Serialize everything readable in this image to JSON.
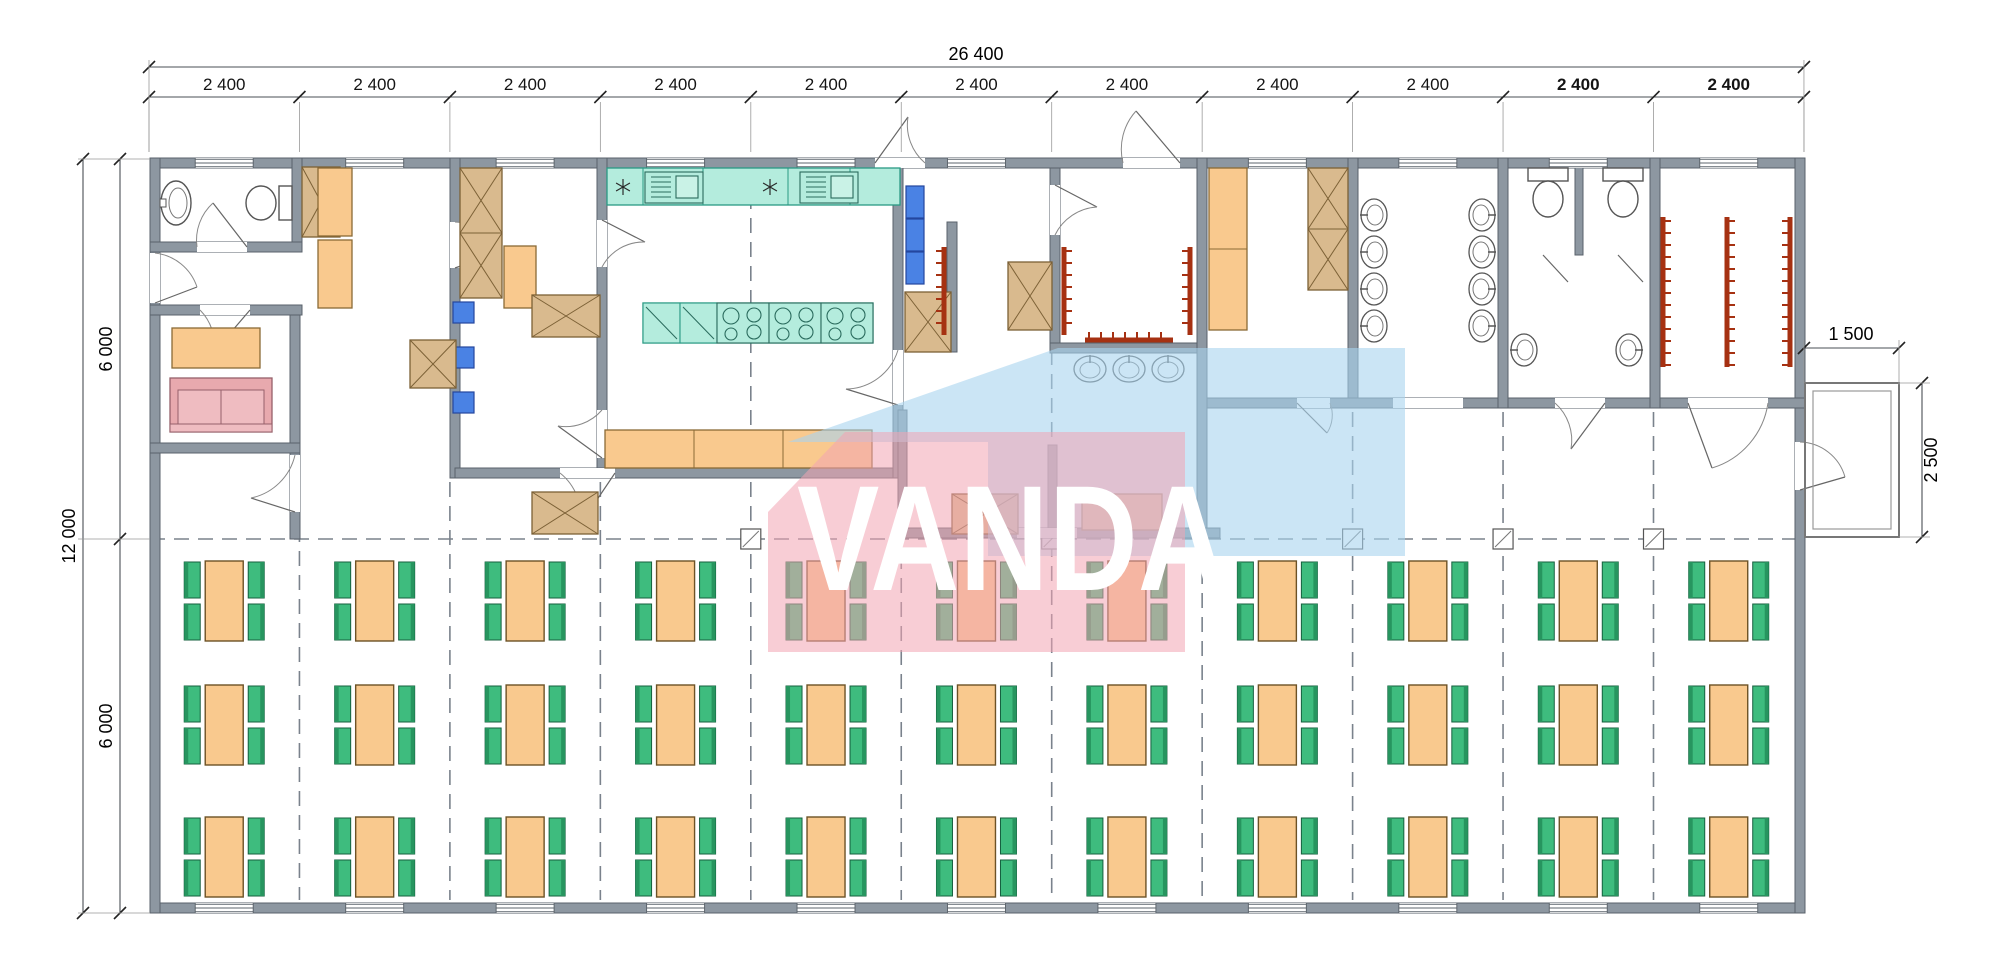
{
  "watermark": {
    "text": "VANDA"
  },
  "dimensions": {
    "top_total": {
      "label": "26 400"
    },
    "bays": [
      {
        "label": "2 400",
        "bold": false
      },
      {
        "label": "2 400",
        "bold": false
      },
      {
        "label": "2 400",
        "bold": false
      },
      {
        "label": "2 400",
        "bold": false
      },
      {
        "label": "2 400",
        "bold": false
      },
      {
        "label": "2 400",
        "bold": false
      },
      {
        "label": "2 400",
        "bold": false
      },
      {
        "label": "2 400",
        "bold": false
      },
      {
        "label": "2 400",
        "bold": false
      },
      {
        "label": "2 400",
        "bold": true
      },
      {
        "label": "2 400",
        "bold": true
      }
    ],
    "left_total": {
      "label": "12 000"
    },
    "left_halves": [
      {
        "label": "6 000"
      },
      {
        "label": "6 000"
      }
    ],
    "porch_width": {
      "label": "1 500"
    },
    "porch_depth": {
      "label": "2 500"
    }
  },
  "dining": {
    "rows": 3,
    "columns": 11,
    "tables_total": 33,
    "seats_per_table": 4
  },
  "colors": {
    "wall": "#8d97a1",
    "wall_stroke": "#59626b",
    "thin_line": "#5d656d",
    "dim_line": "#4a4f55",
    "dim_text": "#141414",
    "teal_fill": "#b4ecdd",
    "teal_stroke": "#2a9a84",
    "orange_fill": "#f9c98e",
    "orange_stroke": "#8a6a35",
    "green_fill": "#3ebc7e",
    "green_dark": "#27955f",
    "green_stroke": "#155f3e",
    "tan_fill": "#d9ba8e",
    "tan_stroke": "#7c6136",
    "blue_fill": "#4a82e4",
    "blue_stroke": "#24479e",
    "pink_fill": "#e8a9ae",
    "pink_stroke": "#96606a",
    "red_rack": "#a63112",
    "dash": "#7a828c",
    "wm_pink": "rgba(243,164,178,0.55)",
    "wm_blue": "rgba(168,212,238,0.60)"
  }
}
